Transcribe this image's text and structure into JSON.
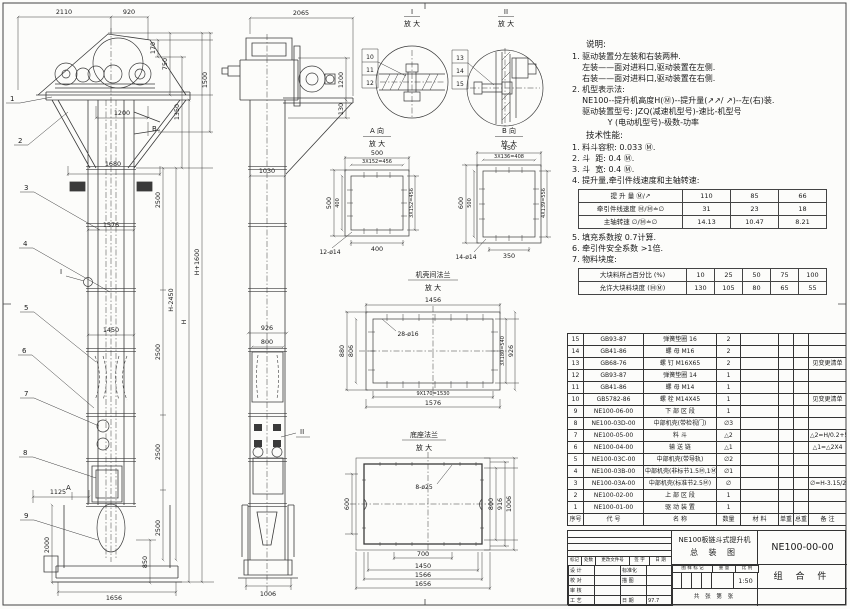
{
  "front_view": {
    "leaders": [
      "1",
      "2",
      "3",
      "4",
      "5",
      "6",
      "7",
      "8",
      "9"
    ],
    "marks": {
      "a": "A",
      "b": "B",
      "i": "I"
    },
    "dims": {
      "top_left": "2110",
      "top_right": "920",
      "head_170": "170",
      "head_750": "750",
      "head_1350": "1350",
      "head_1500": "1500",
      "inlet_1200": "1200",
      "flange_1680": "1680",
      "sec_2500_1": "2500",
      "flange_1576": "1576",
      "sec_2500_2": "2500",
      "sec_2500_3": "2500",
      "sec_2500_4": "2500",
      "h_mid": "H-2450",
      "h": "H",
      "h_total": "H+1600",
      "mid_1450": "1450",
      "boot_1125": "1125",
      "boot_2000": "2000",
      "boot_850": "850",
      "base_1656": "1656"
    }
  },
  "side_view": {
    "mark_ii": "II",
    "dims": {
      "top_2065": "2065",
      "drive_1200": "1200",
      "shelf_130": "130",
      "col_1030": "1030",
      "mid_926": "926",
      "mid_800": "800",
      "base_1006": "1006"
    }
  },
  "detail_i": {
    "title": "I",
    "sub": "放 大",
    "leaders": [
      "10",
      "11",
      "12"
    ]
  },
  "detail_ii": {
    "title": "II",
    "sub": "放 大",
    "leaders": [
      "13",
      "14",
      "15"
    ]
  },
  "detail_a": {
    "title": "A 向",
    "sub": "放 大",
    "dims": {
      "top": "500",
      "top2": "3X152=456",
      "left": "500",
      "left2": "400",
      "right": "3X152=456",
      "bottom": "400",
      "holes": "12-ø14"
    }
  },
  "detail_b": {
    "title": "B 向",
    "sub": "放 大",
    "dims": {
      "top": "450",
      "top2": "3X136=408",
      "left": "600",
      "left2": "500",
      "right": "4X139=556",
      "bottom": "350",
      "holes": "14-ø14"
    }
  },
  "detail_flange": {
    "title": "机壳间法兰",
    "sub": "放 大",
    "dims": {
      "top": "1456",
      "holes": "28-ø16",
      "left": "880",
      "left2": "806",
      "right": "3X180=540",
      "right2": "926",
      "bottom": "9X170=1530",
      "bottom2": "1576"
    }
  },
  "detail_base": {
    "title": "底座法兰",
    "sub": "放 大",
    "dims": {
      "holes": "8-ø25",
      "left": "600",
      "right": "800",
      "right2": "916",
      "right3": "1006",
      "bottom": "700",
      "bottom2": "1450",
      "bottom3": "1566",
      "bottom4": "1656"
    }
  },
  "notes": {
    "heading": "说明:",
    "lines": [
      "1. 驱动装置分左装和右装两种.",
      "    左装——面对进料口,驱动装置在左侧.",
      "    右装——面对进料口,驱动装置在右侧.",
      "2. 机型表示法:",
      "    NE100--提升机高度H(Ⓜ)--提升量(↗↗/ ↗)--左(右)装.",
      "    驱动装置型号: JZQ(减速机型号)-速比-机型号",
      "              Y (电动机型号)-极数-功率"
    ],
    "tech_heading": "技术性能:",
    "tech_lines_pre": [
      "1. 料斗容积: 0.033 Ⓜ.",
      "2. 斗  距: 0.4 Ⓜ.",
      "3. 斗  宽: 0.4 Ⓜ.",
      "4. 提升量,牵引件线速度和主轴转速:"
    ],
    "speed_table_rows": [
      [
        "提 升 量  Ⓜ/↗",
        "110",
        "85",
        "66"
      ],
      [
        "牵引件线速度  Ⓜ/Ⓜ≐∅",
        "31",
        "23",
        "18"
      ],
      [
        "主轴转速  ∅/Ⓜ≐∅",
        "14.13",
        "10.47",
        "8.21"
      ]
    ],
    "tech_lines_post": [
      "5. 填充系数按 0.7计算.",
      "6. 牵引件安全系数 >1倍.",
      "7. 物料块度:"
    ],
    "lump_table_rows": [
      [
        "大块料所占百分比 (%)",
        "10",
        "25",
        "50",
        "75",
        "100"
      ],
      [
        "允许大块料块度 (ⓂⓂ)",
        "130",
        "105",
        "80",
        "65",
        "55"
      ]
    ]
  },
  "bom": {
    "rows": [
      [
        "15",
        "GB93-87",
        "弹簧垫圈 16",
        "2",
        "",
        "",
        "",
        ""
      ],
      [
        "14",
        "GB41-86",
        "螺 母  M16",
        "2",
        "",
        "",
        "",
        ""
      ],
      [
        "13",
        "GB68-76",
        "螺 钉  M16X65",
        "2",
        "",
        "",
        "",
        "见变更清单"
      ],
      [
        "12",
        "GB93-87",
        "弹簧垫圈 14",
        "1",
        "",
        "",
        "",
        ""
      ],
      [
        "11",
        "GB41-86",
        "螺 母  M14",
        "1",
        "",
        "",
        "",
        ""
      ],
      [
        "10",
        "GB5782-86",
        "螺 栓  M14X45",
        "1",
        "",
        "",
        "",
        "见变更清单"
      ],
      [
        "9",
        "NE100-06-00",
        "下 部 区 段",
        "1",
        "",
        "",
        "",
        ""
      ],
      [
        "8",
        "NE100-03D-00",
        "中部机壳(带检视门)",
        "∅3",
        "",
        "",
        "",
        ""
      ],
      [
        "7",
        "NE100-05-00",
        "料 斗",
        "△2",
        "",
        "",
        "",
        "△2=H/0.2+5.75"
      ],
      [
        "6",
        "NE100-04-00",
        "输 送 链",
        "△1",
        "",
        "",
        "",
        "△1=△2X4"
      ],
      [
        "5",
        "NE100-03C-00",
        "中部机壳(带导轨)",
        "∅2",
        "",
        "",
        "",
        ""
      ],
      [
        "4",
        "NE100-03B-00",
        "中部机壳(非标节1.5Ⓜ,1Ⓜ)",
        "∅1",
        "",
        "",
        "",
        ""
      ],
      [
        "3",
        "NE100-03A-00",
        "中部机壳(标准节2.5Ⓜ)",
        "∅",
        "",
        "",
        "",
        "∅=H-3.15/2.5"
      ],
      [
        "2",
        "NE100-02-00",
        "上 部 区 段",
        "1",
        "",
        "",
        "",
        ""
      ],
      [
        "1",
        "NE100-01-00",
        "驱 动 装 置",
        "1",
        "",
        "",
        "",
        ""
      ]
    ],
    "header_rows": [
      [
        "序号",
        "代  号",
        "名  称",
        "数量",
        "材  料",
        "单重",
        "总重",
        "备  注"
      ]
    ]
  },
  "title_block": {
    "mini_header": [
      "标记",
      "处数",
      "更改文件号",
      "签 字",
      "日 期"
    ],
    "sign_rows": [
      [
        "设 计",
        "",
        "标准化",
        ""
      ],
      [
        "校 对",
        "",
        "描 图",
        ""
      ],
      [
        "审 核",
        "",
        "",
        ""
      ],
      [
        "工 艺",
        "",
        "日 期",
        "97.7"
      ]
    ],
    "title_line1": "NE100板链斗式提升机",
    "title_line2": "总 装 图",
    "stamp_header_rows": [
      [
        "图 样 标 记",
        "重 量",
        "比 例"
      ]
    ],
    "scale": "1:50",
    "sheet_note": "共  张  第  张",
    "code": "NE100-00-00",
    "part_type": "组 合 件"
  }
}
